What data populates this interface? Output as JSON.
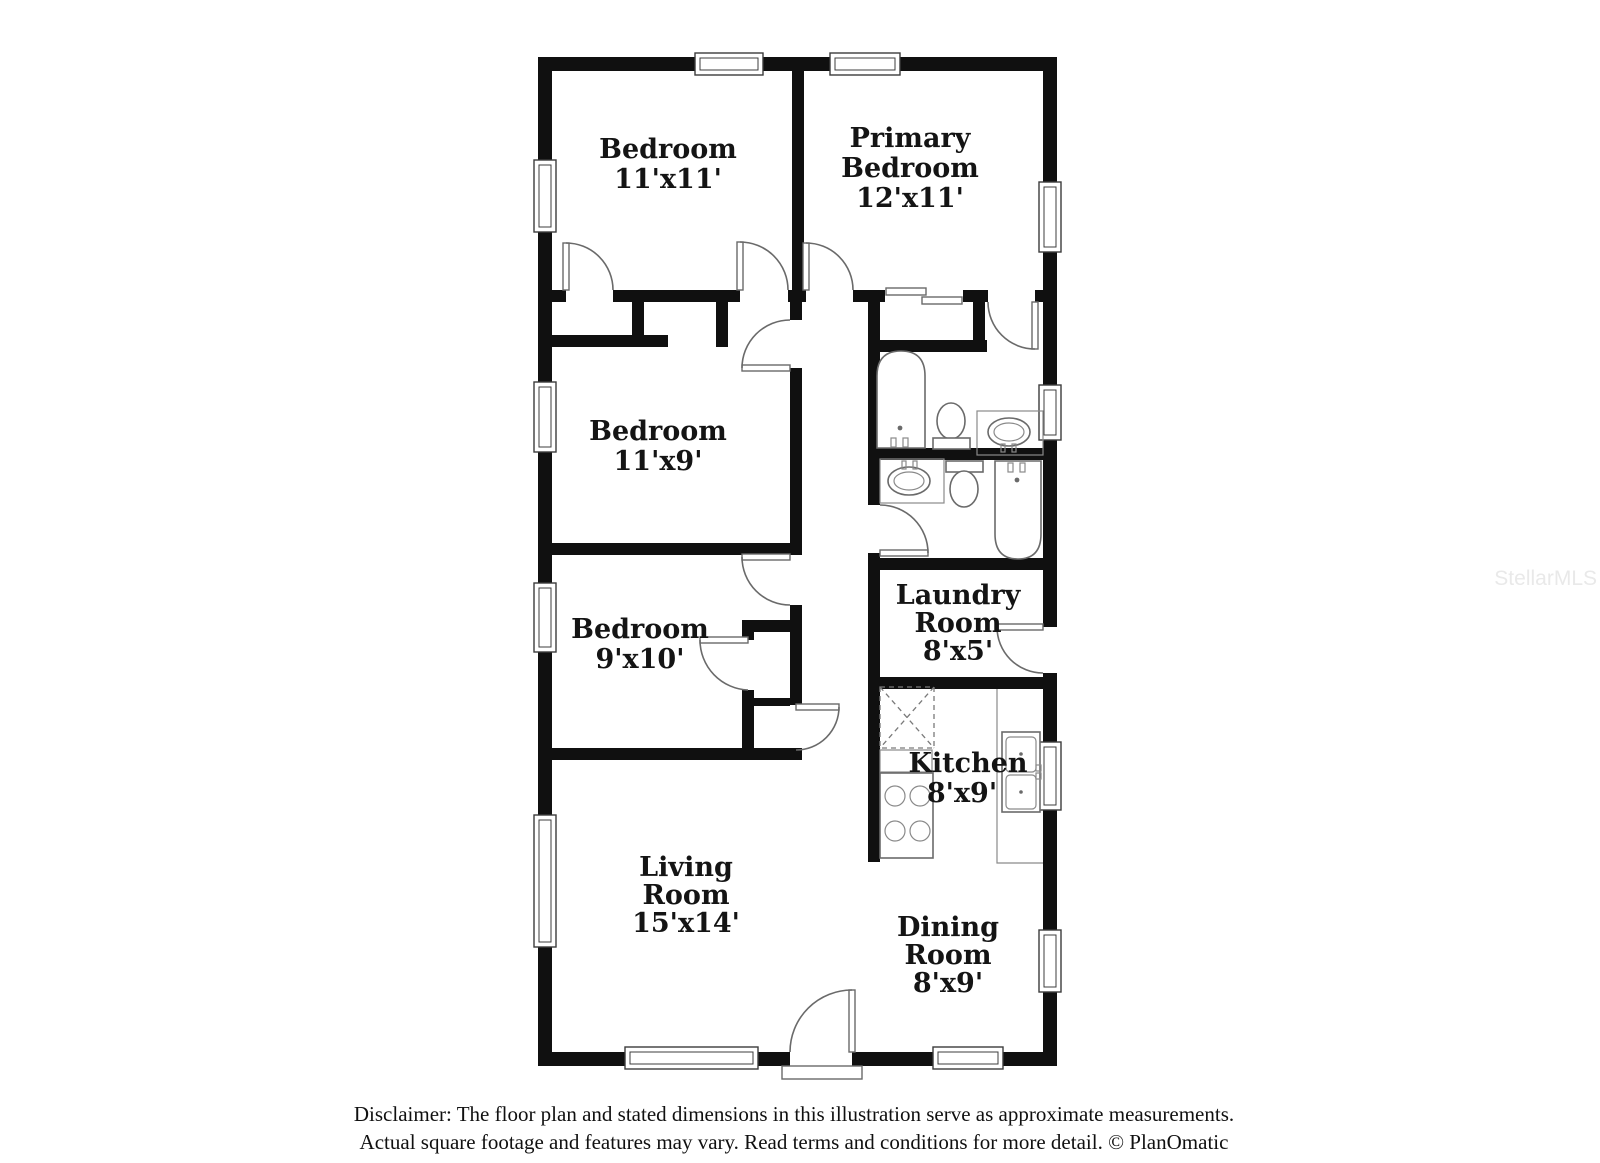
{
  "watermark": "StellarMLS",
  "disclaimer": {
    "line1": "Disclaimer: The floor plan and stated dimensions in this illustration serve as approximate measurements.",
    "line2": "Actual square footage and features may vary. Read terms and conditions for more detail. © PlanOmatic"
  },
  "rooms": {
    "bedroom1": {
      "name": "Bedroom",
      "dims": "11'x11'"
    },
    "primary": {
      "line1": "Primary",
      "line2": "Bedroom",
      "dims": "12'x11'"
    },
    "bedroom2": {
      "name": "Bedroom",
      "dims": "11'x9'"
    },
    "bedroom3": {
      "name": "Bedroom",
      "dims": "9'x10'"
    },
    "laundry": {
      "line1": "Laundry",
      "line2": "Room",
      "dims": "8'x5'"
    },
    "kitchen": {
      "name": "Kitchen",
      "dims": "8'x9'"
    },
    "living": {
      "line1": "Living",
      "line2": "Room",
      "dims": "15'x14'"
    },
    "dining": {
      "line1": "Dining",
      "line2": "Room",
      "dims": "8'x9'"
    }
  },
  "colors": {
    "wall": "#101010",
    "fixture_stroke": "#6a6a6a",
    "label_text": "#141414",
    "watermark_text": "#e9e9e9",
    "background": "#ffffff"
  }
}
